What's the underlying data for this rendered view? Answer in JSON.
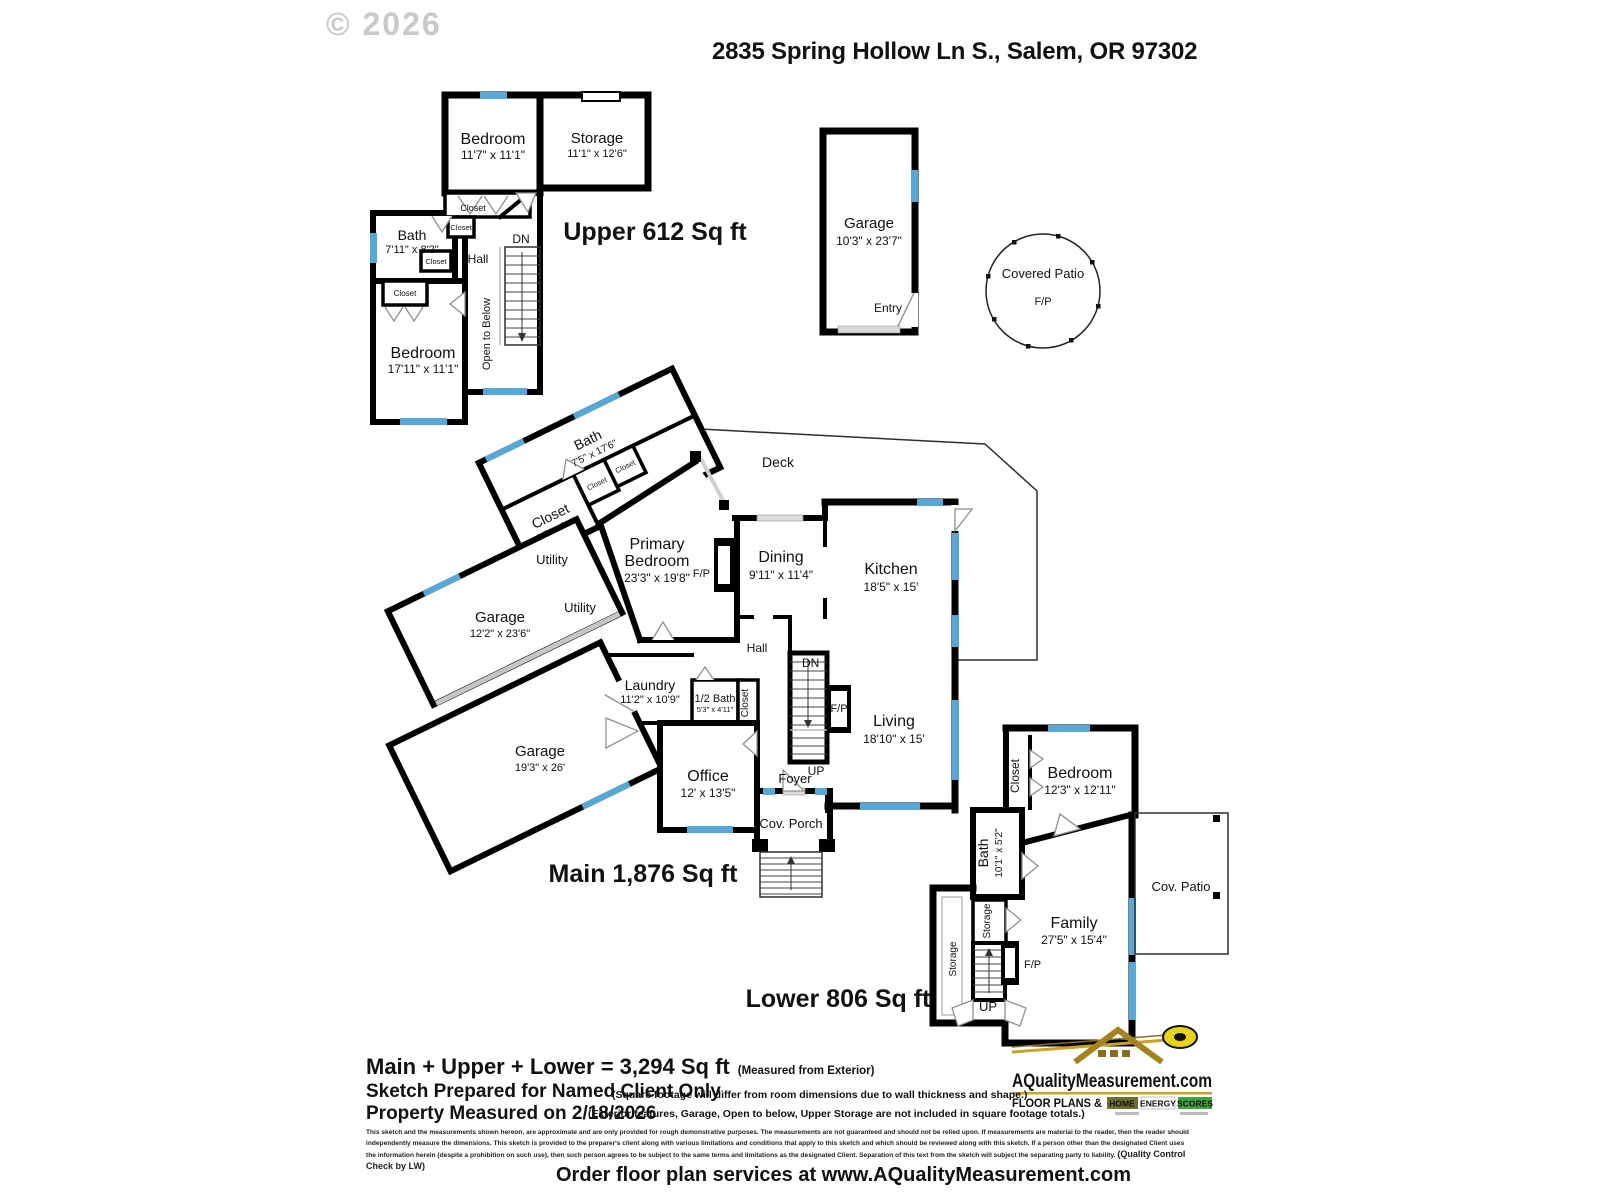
{
  "header": {
    "copyright": "© 2026",
    "title": "2835 Spring Hollow Ln S., Salem, OR 97302"
  },
  "labels": {
    "closet": "Closet",
    "storage": "Storage",
    "utility": "Utility",
    "hall": "Hall",
    "dn": "DN",
    "up": "UP",
    "fp": "F/P",
    "entry": "Entry",
    "deck": "Deck",
    "foyer": "Foyer",
    "cov_porch": "Cov. Porch",
    "cov_patio": "Cov. Patio",
    "open_to_below": "Open to Below"
  },
  "upper": {
    "label": "Upper  612 Sq ft",
    "bedroom1": {
      "name": "Bedroom",
      "dims": "11'7\" x 11'1\""
    },
    "storage": {
      "name": "Storage",
      "dims": "11'1\" x 12'6\""
    },
    "bath": {
      "name": "Bath",
      "dims": "7'11\" x 8'2\""
    },
    "bedroom2": {
      "name": "Bedroom",
      "dims": "17'11\" x 11'1\""
    }
  },
  "garage_upper": {
    "name": "Garage",
    "dims": "10'3\" x 23'7\""
  },
  "patio": {
    "name": "Covered Patio"
  },
  "main": {
    "label": "Main  1,876 Sq ft",
    "bath": {
      "name": "Bath",
      "dims": "7'5\" x 17'6\""
    },
    "closet": {
      "name": "Closet",
      "dims": "9'5\" x 9'4\""
    },
    "garage1": {
      "name": "Garage",
      "dims": "12'2\" x 23'6\""
    },
    "garage2": {
      "name": "Garage",
      "dims": "19'3\" x 26'"
    },
    "primary": {
      "line1": "Primary",
      "line2": "Bedroom",
      "dims": "23'3\" x 19'8\""
    },
    "dining": {
      "name": "Dining",
      "dims": "9'11\" x 11'4\""
    },
    "kitchen": {
      "name": "Kitchen",
      "dims": "18'5\" x 15'"
    },
    "living": {
      "name": "Living",
      "dims": "18'10\" x 15'"
    },
    "laundry": {
      "name": "Laundry",
      "dims": "11'2\" x 10'9\""
    },
    "half_bath": {
      "name": "1/2 Bath",
      "dims": "5'3\" x 4'11\""
    },
    "office": {
      "name": "Office",
      "dims": "12' x 13'5\""
    }
  },
  "lower": {
    "label": "Lower  806 Sq ft",
    "bedroom": {
      "name": "Bedroom",
      "dims": "12'3\" x 12'11\""
    },
    "bath": {
      "name": "Bath",
      "dims": "10'1\" x 5'2\""
    },
    "family": {
      "name": "Family",
      "dims": "27'5\" x 15'4\""
    }
  },
  "footer": {
    "total": "Main + Upper + Lower = 3,294 Sq ft",
    "total_note": "(Measured from Exterior)",
    "sketch_line": "Sketch Prepared for Named Client Only",
    "measured_line": "Property Measured on 2/18/2026",
    "note1": "(Square footage will differ from room dimensions due to wall thickness and shape.)",
    "note2": "(Exterior features, Garage, Open to below, Upper Storage are not included in square footage totals.)",
    "disclaimer": "This sketch and the measurements shown hereon, are approximate and are only provided for rough demonstrative purposes.  The measurements are not guaranteed and should not be relied upon.  If measurements are material to the reader, then the reader should independently measure the dimensions.  This sketch is provided to the preparer's client along with various limitations and conditions that apply to this sketch and which should be reviewed along with this sketch.  If a person other than the designated Client uses the information herein (despite a prohibition on such use), then such person agrees to be subject to the same terms and limitations as the designated Client.  Separation of this text from the sketch will subject the separating party to liability.  ",
    "qc": "(Quality Control Check by LW)",
    "order_line": "Order floor plan services at www.AQualityMeasurement.com"
  },
  "logo": {
    "site": "AQualityMeasurement.com",
    "tagline_left": "FLOOR PLANS &",
    "badge1": "HOME",
    "badge2": "ENERGY",
    "badge3": "SCORES"
  },
  "colors": {
    "window": "#57a8d6",
    "wall": "#000000",
    "logo_gold": "#c9a227",
    "logo_navy": "#1b1b70",
    "badge_green": "#3fa33f"
  }
}
